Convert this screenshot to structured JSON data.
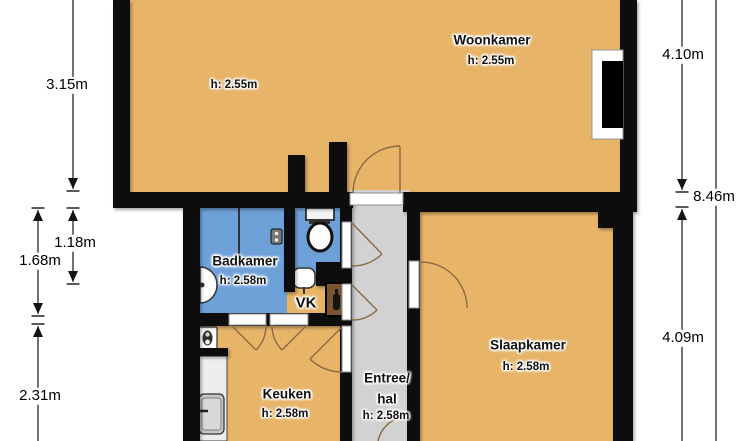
{
  "colors": {
    "floor_orange": "#E7B468",
    "wet_blue": "#6FA1D9",
    "hall_gray": "#D2D2D2",
    "wall_black": "#0A0A0A",
    "door_brown": "#8A6A45"
  },
  "rooms": {
    "woonkamer": {
      "name": "Woonkamer",
      "ceiling_height": "h: 2.55m",
      "ceiling_height_left": "h: 2.55m"
    },
    "badkamer": {
      "name": "Badkamer",
      "ceiling_height": "h: 2.58m"
    },
    "vk": {
      "name": "VK"
    },
    "keuken": {
      "name": "Keuken",
      "ceiling_height": "h: 2.58m"
    },
    "entree": {
      "name_line1": "Entree/",
      "name_line2": "hal",
      "ceiling_height": "h: 2.58m"
    },
    "slaapkamer": {
      "name": "Slaapkamer",
      "ceiling_height": "h: 2.58m"
    }
  },
  "dimensions": {
    "left_top": "3.15m",
    "left_inner": "1.18m",
    "left_outer_mid": "1.68m",
    "left_bottom": "2.31m",
    "right_top": "4.10m",
    "right_total": "8.46m",
    "right_bottom": "4.09m"
  }
}
